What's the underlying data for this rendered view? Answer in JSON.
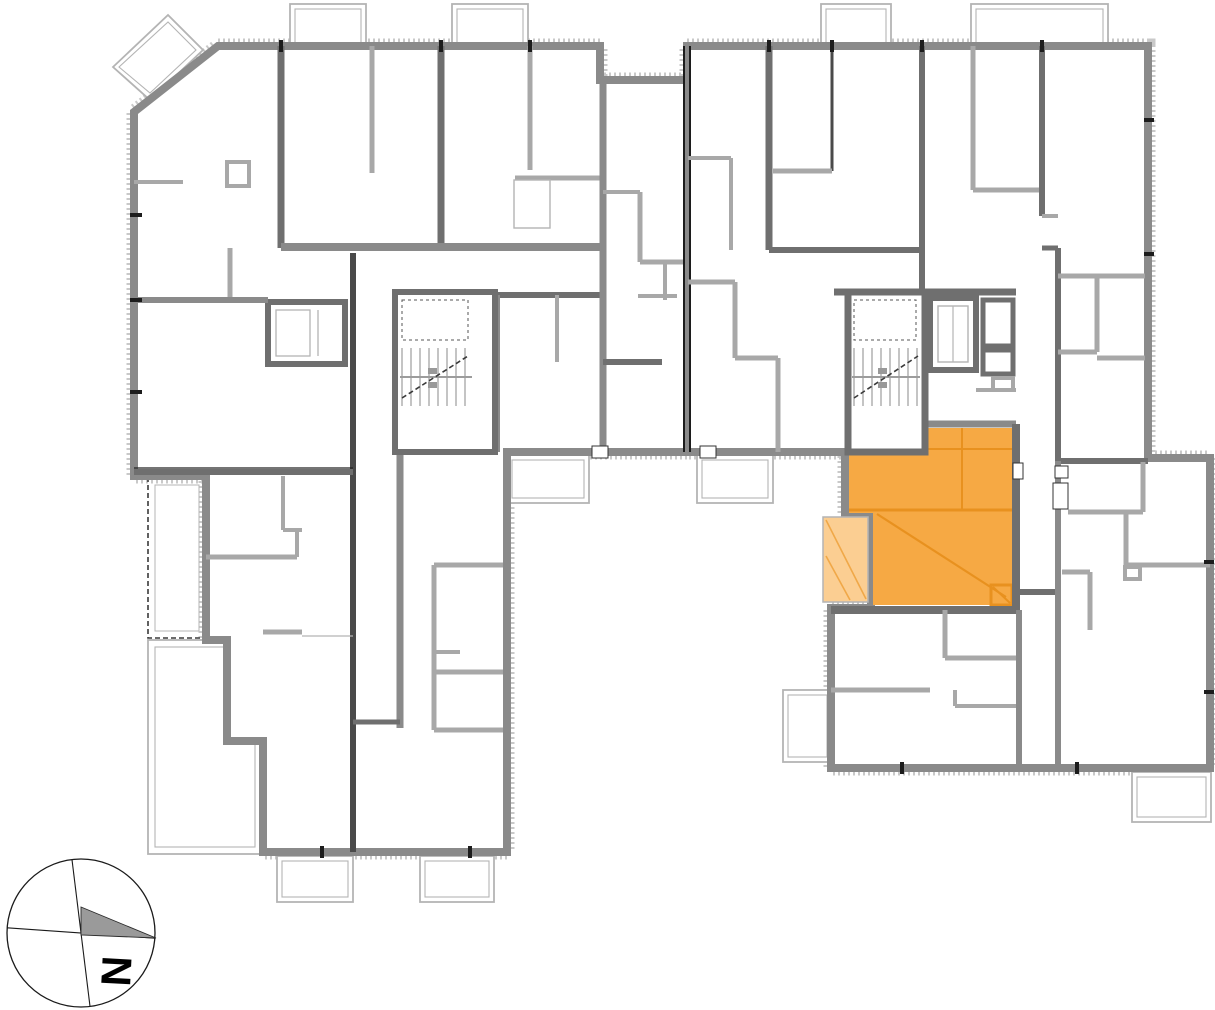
{
  "compass": {
    "label": "N"
  },
  "colors": {
    "background": "#ffffff",
    "wall_primary": "#8a8a8a",
    "wall_dark": "#6f6f6f",
    "wall_black": "#4a4a4a",
    "partition": "#a8a8a8",
    "thin_outline": "#b4b4b4",
    "hatch": "#c9c9c9",
    "accent_black": "#1c1c1c",
    "stair_line": "#9c9c9c",
    "highlight_fill": "#f6a944",
    "highlight_line": "#e8911f",
    "highlight_balcony_fill": "#fbce92",
    "highlight_balcony_line": "#f0a848",
    "compass_arrow": "#9a9a9a"
  }
}
